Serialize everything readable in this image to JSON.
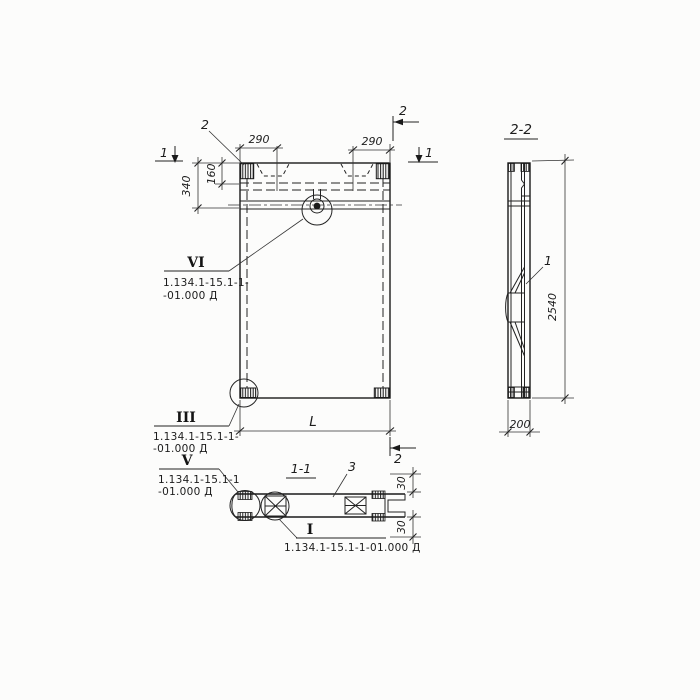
{
  "drawing": {
    "colors": {
      "ink": "#1c1c1c",
      "paper": "#fcfcfb"
    },
    "front_view": {
      "section_mark_1_left": "1",
      "section_mark_1_right": "1",
      "section_mark_2_top": "2",
      "section_mark_2_bottom": "2",
      "part_label_2": "2",
      "dim_290_left": "290",
      "dim_290_right": "290",
      "dim_160": "160",
      "dim_340": "340",
      "dim_length": "L"
    },
    "side_view": {
      "title": "2-2",
      "part_label_1": "1",
      "dim_height": "2540",
      "dim_width": "200"
    },
    "section_view": {
      "title": "1-1",
      "part_label_3": "3",
      "dim_30_top": "30",
      "dim_30_bottom": "30"
    },
    "callouts": {
      "vi": {
        "numeral": "VI",
        "ref_line1": "1.134.1-15.1-1-",
        "ref_line2": "-01.000 Д"
      },
      "iii": {
        "numeral": "III",
        "ref_line1": "1.134.1-15.1-1-",
        "ref_line2": "-01.000 Д"
      },
      "v": {
        "numeral": "V",
        "ref_line1": "1.134.1-15.1-1",
        "ref_line2": "-01.000 Д"
      },
      "i": {
        "numeral": "I",
        "ref": "1.134.1-15.1-1-01.000 Д"
      }
    }
  }
}
